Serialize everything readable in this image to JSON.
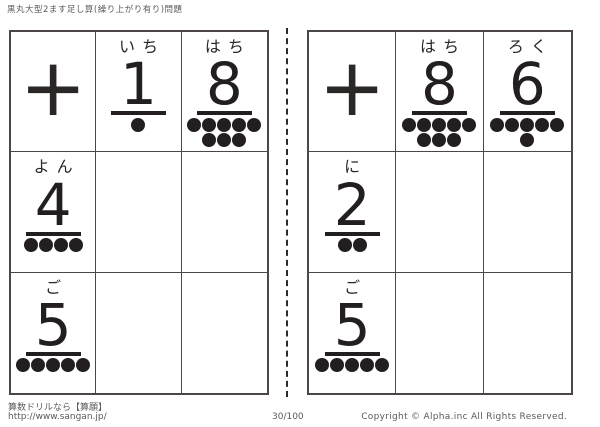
{
  "header": {
    "title": "黒丸大型2ます足し算(繰り上がり有り)問題"
  },
  "tables": [
    {
      "operator": "+",
      "top_numbers": [
        {
          "label": "いち",
          "digit": "1",
          "dot_rows": [
            1
          ]
        },
        {
          "label": "はち",
          "digit": "8",
          "dot_rows": [
            5,
            3
          ]
        }
      ],
      "left_numbers": [
        {
          "label": "よん",
          "digit": "4",
          "dot_rows": [
            4
          ]
        },
        {
          "label": "ご",
          "digit": "5",
          "dot_rows": [
            5
          ]
        }
      ]
    },
    {
      "operator": "+",
      "top_numbers": [
        {
          "label": "はち",
          "digit": "8",
          "dot_rows": [
            5,
            3
          ]
        },
        {
          "label": "ろく",
          "digit": "6",
          "dot_rows": [
            5,
            1
          ]
        }
      ],
      "left_numbers": [
        {
          "label": "に",
          "digit": "2",
          "dot_rows": [
            2
          ]
        },
        {
          "label": "ご",
          "digit": "5",
          "dot_rows": [
            5
          ]
        }
      ]
    }
  ],
  "footer": {
    "site_label": "算数ドリルなら【算願】",
    "site_url": "http://www.sangan.jp/",
    "page_indicator": "30/100",
    "copyright": "Copyright © Alpha.inc All Rights Reserved."
  },
  "colors": {
    "dot": "#231f20",
    "grid_line": "#4c4648",
    "muted_text": "#5a5a5a"
  }
}
